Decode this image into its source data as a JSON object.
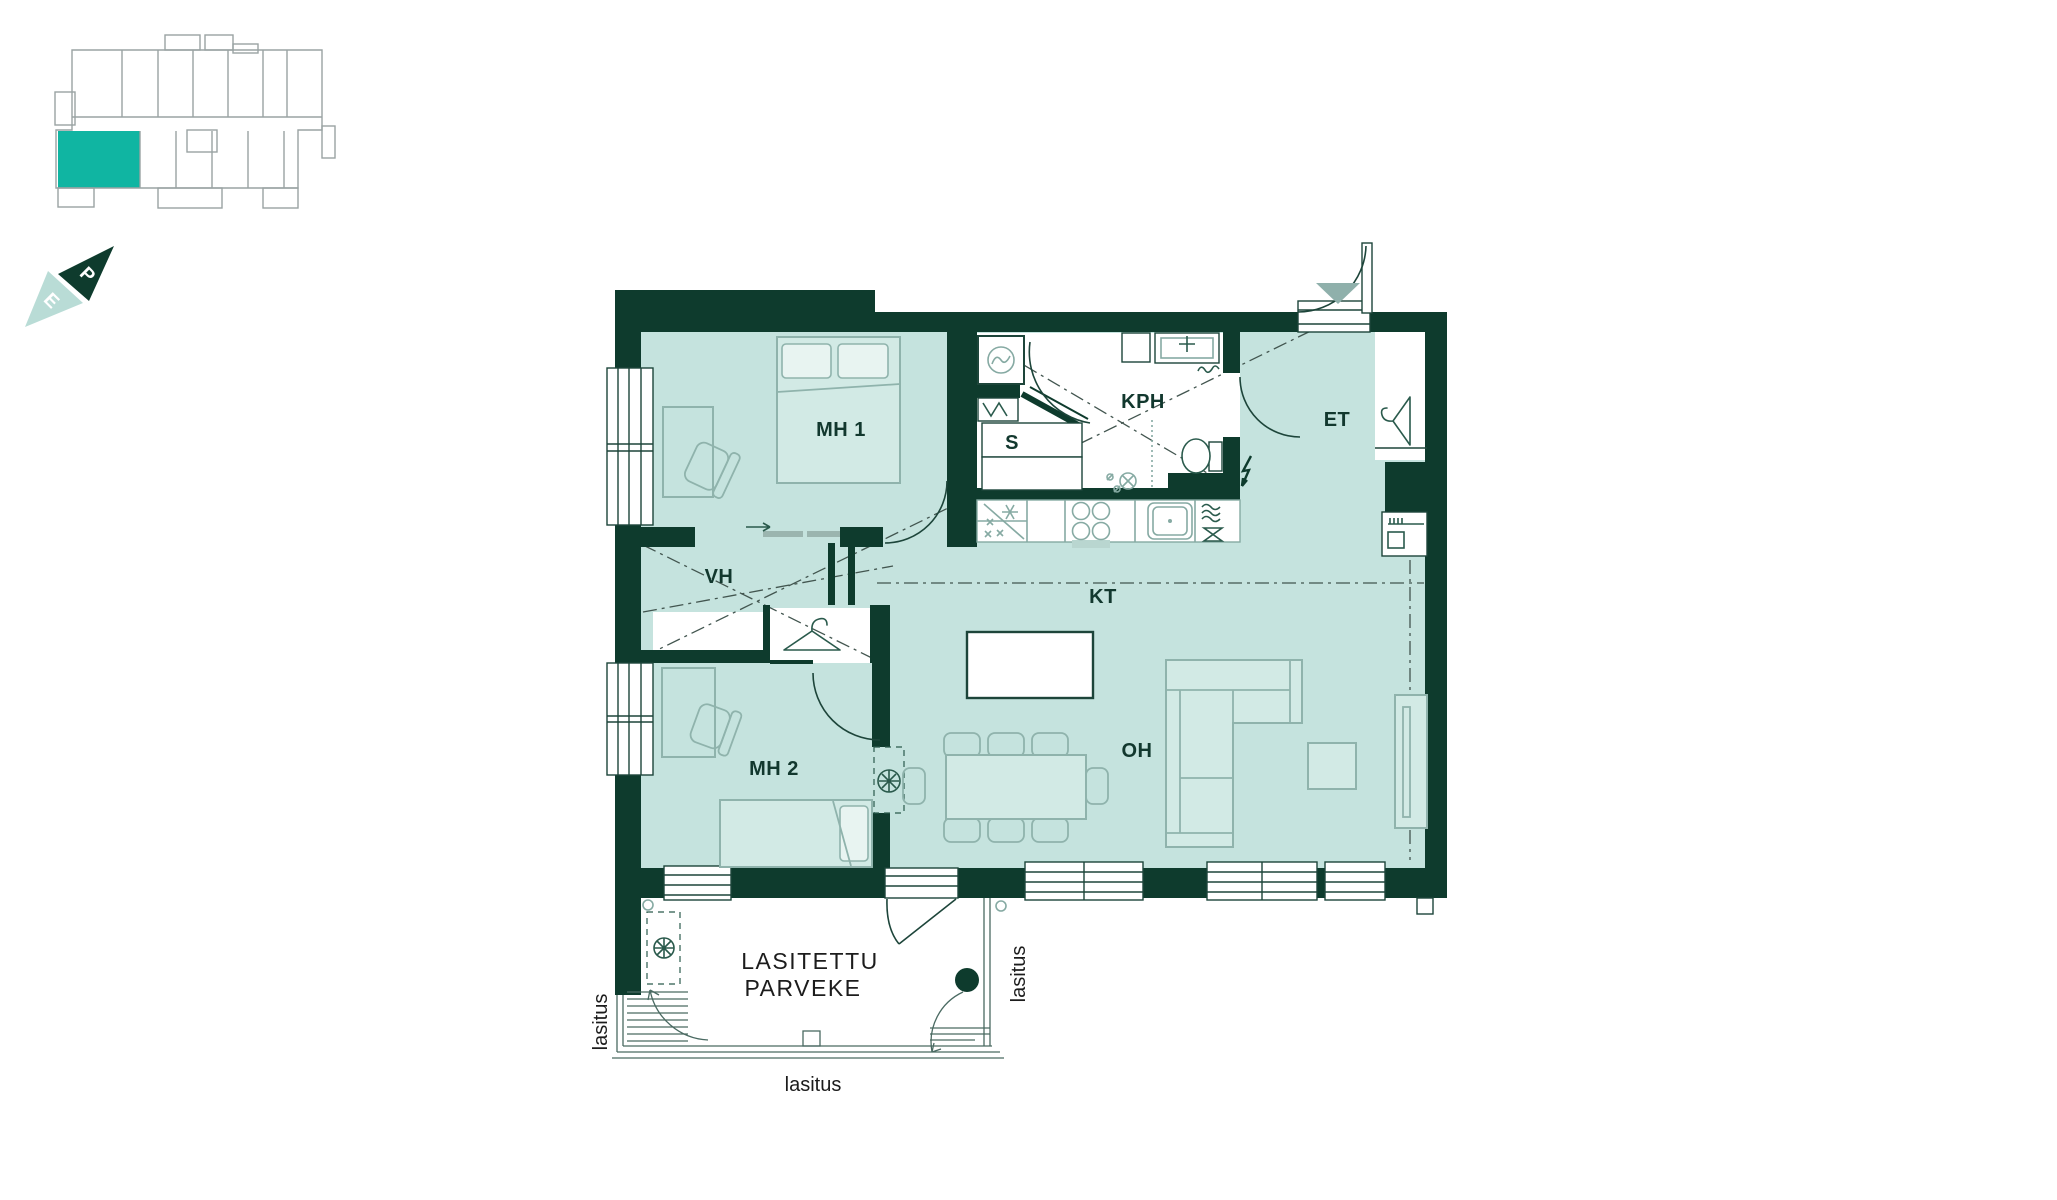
{
  "overview": {
    "description": "building floor overview with current apartment highlighted",
    "highlight_color": "#10b5a2",
    "outline_color": "#9aa3a3"
  },
  "compass": {
    "north": "P",
    "south": "E",
    "dark_color": "#0e3b2d",
    "light_color": "#b9dcd6"
  },
  "rooms": {
    "mh1": "MH 1",
    "kph": "KPH",
    "sauna": "S",
    "et": "ET",
    "vh": "VH",
    "kt": "KT",
    "mh2": "MH 2",
    "oh": "OH"
  },
  "balcony": {
    "title_line1": "LASITETTU",
    "title_line2": "PARVEKE",
    "glazing": "lasitus"
  },
  "colors": {
    "wall": "#0e3b2d",
    "floor": "#c5e3de",
    "furniture_stroke": "#8fb3ac",
    "label_text": "#12382e",
    "black_text": "#1c1c1c"
  }
}
